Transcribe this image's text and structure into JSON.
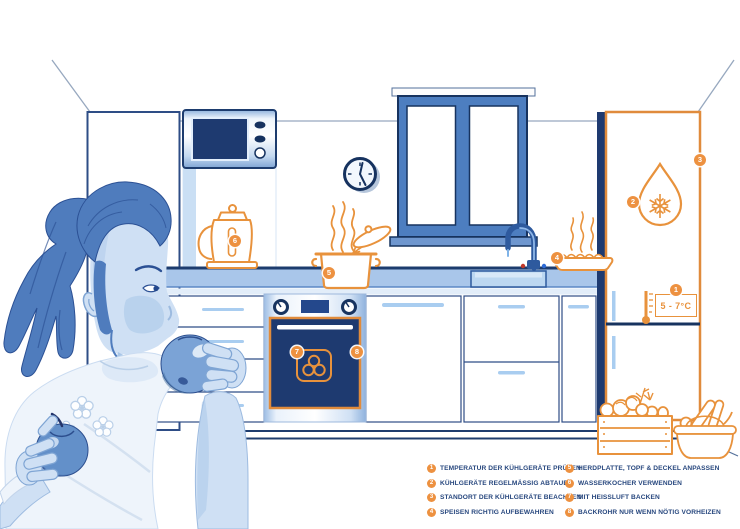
{
  "colors": {
    "accent_orange": "#ed9140",
    "outline_orange": "#e8923c",
    "navy": "#1d3c6e",
    "mid_blue": "#4d7ec0",
    "light_blue": "#bcd7f1"
  },
  "scene": {
    "markers": [
      "1",
      "2",
      "3",
      "4",
      "5",
      "6",
      "7",
      "8"
    ],
    "fridge": {
      "temp_label": "5 - 7°C"
    },
    "icons": [
      "defrost-droplet-snowflake",
      "thermometer",
      "convection-fan",
      "pot-with-lid",
      "kettle",
      "steaming-dish",
      "faucet",
      "wall-clock",
      "microwave",
      "window",
      "vegetable-crate",
      "bread-basket",
      "girl-eating-apple"
    ]
  },
  "legend": {
    "items_left": [
      {
        "num": "1",
        "label": "TEMPERATUR DER KÜHLGERÄTE PRÜFEN"
      },
      {
        "num": "2",
        "label": "KÜHLGERÄTE REGELMÄSSIG ABTAUEN"
      },
      {
        "num": "3",
        "label": "STANDORT DER KÜHLGERÄTE BEACHTEN"
      },
      {
        "num": "4",
        "label": "SPEISEN RICHTIG AUFBEWAHREN"
      }
    ],
    "items_right": [
      {
        "num": "5",
        "label": "HERDPLATTE, TOPF & DECKEL ANPASSEN"
      },
      {
        "num": "6",
        "label": "WASSERKOCHER VERWENDEN"
      },
      {
        "num": "7",
        "label": "MIT HEISSLUFT BACKEN"
      },
      {
        "num": "8",
        "label": "BACKROHR NUR WENN NÖTIG VORHEIZEN"
      }
    ]
  }
}
